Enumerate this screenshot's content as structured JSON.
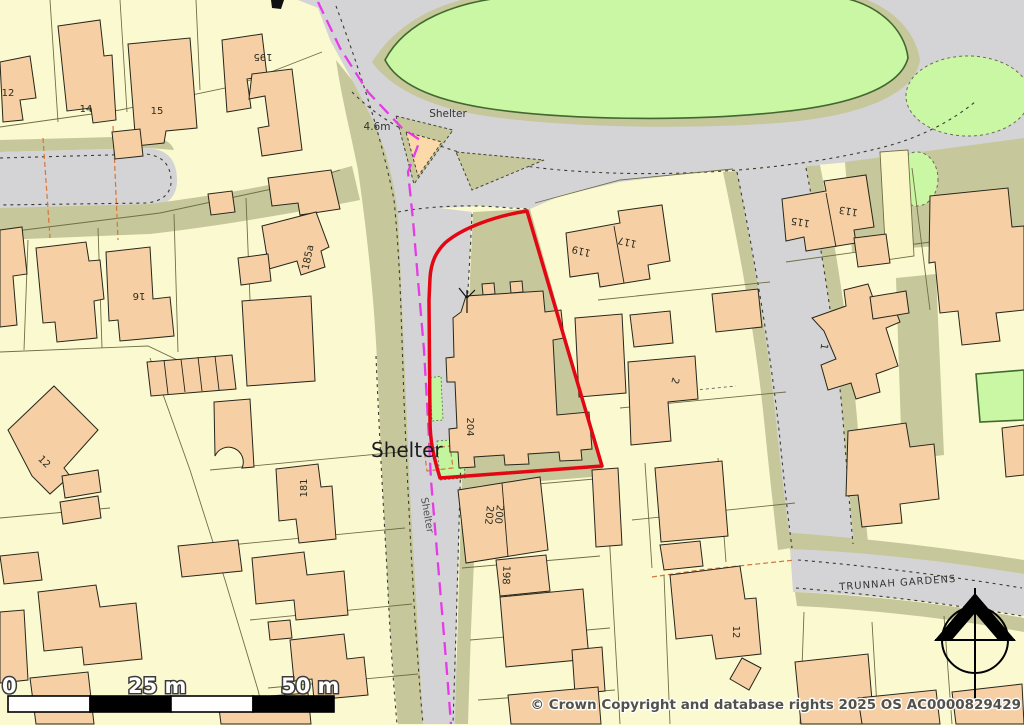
{
  "map": {
    "copyright": "© Crown Copyright and database rights 2025 OS AC0000829429",
    "scale_bar": {
      "start": "0",
      "mid": "25 m",
      "end": "50 m"
    },
    "street_labels": {
      "trunnah": "TRUNNAH GARDENS"
    },
    "poi_labels": {
      "shelter_top": "Shelter",
      "shelter_big": "Shelter",
      "shelter_road": "Shelter",
      "spot_height": "4.6m"
    },
    "house_numbers": {
      "n12a": "12",
      "n14": "14",
      "n15": "15",
      "n195": "195",
      "n16": "16",
      "n185a": "185a",
      "n12b": "12",
      "n181": "181",
      "n204": "204",
      "n200": "200",
      "n202": "202",
      "n198": "198",
      "n12c": "12",
      "n119": "119",
      "n117": "117",
      "n115": "115",
      "n113": "113",
      "n1": "1",
      "n2": "2"
    },
    "colors": {
      "parcel": "#fbf9d0",
      "road": "#d4d4d6",
      "verge": "#c6c79b",
      "green": "#c9f7a3",
      "green_bright": "#c2f59e",
      "green_line": "#41682e",
      "building": "#f6cfa4",
      "outline": "#26261a",
      "parcel_line": "#6f6f45",
      "dash": "#3b3b30",
      "orange_dash": "#d4763b",
      "red": "#e30613",
      "magenta": "#e53ce5",
      "label": "#2c2c20",
      "street_label": "#333333",
      "copyright": "#52524a"
    }
  }
}
